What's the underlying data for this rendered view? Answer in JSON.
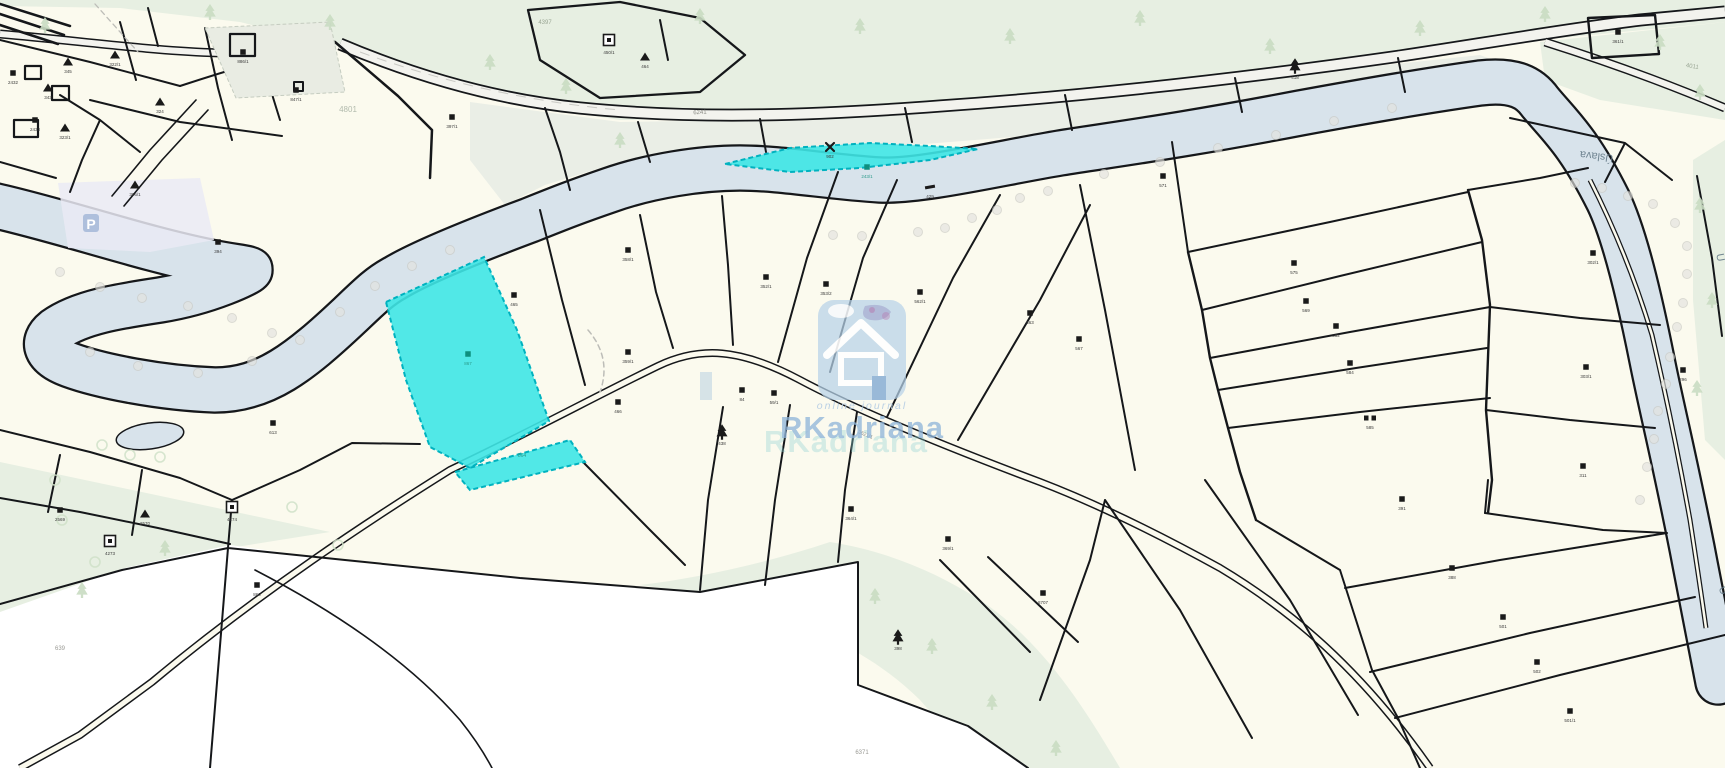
{
  "map": {
    "title": "cadastral-parcel-map",
    "watermark": {
      "brand": "RKadriana",
      "brand_echo": "RKadriana",
      "tagline": "online journal"
    },
    "parking_symbol": "P",
    "colors": {
      "paper": "#fbfaee",
      "forest": "#e7efe2",
      "roadband": "#eaeee6",
      "river": "#d8e3eb",
      "line": "#15171a",
      "white_area": "#ffffff",
      "highlight": "#3ee6e6",
      "highlight_edge": "#00b2bf",
      "watermark_blue": "#8fb5da",
      "watermark_teal": "#8fd2d2",
      "parking": "#aebfdc",
      "dot": "#e3e3df",
      "bush": "#cfe0c8",
      "tree_soft": "#c9dcc2"
    },
    "labels": [
      {
        "t": "Úslava",
        "x": 1597,
        "y": 153,
        "r": 187,
        "s": 11,
        "c": "#647a88",
        "o": 0.9
      },
      {
        "t": "Ú",
        "x": 1717,
        "y": 258,
        "r": 80,
        "s": 11,
        "c": "#647a88",
        "o": 0.9
      },
      {
        "t": "Ú",
        "x": 1720,
        "y": 592,
        "r": 65,
        "s": 11,
        "c": "#647a88",
        "o": 0.9
      },
      {
        "t": "6241",
        "x": 700,
        "y": 114,
        "r": -3,
        "s": 6,
        "c": "#8a8a84",
        "o": 1
      },
      {
        "t": "3621/1",
        "x": 865,
        "y": 436,
        "r": 22,
        "s": 5,
        "c": "#8a8a84",
        "o": 1
      },
      {
        "t": "4397",
        "x": 545,
        "y": 24,
        "r": 0,
        "s": 6,
        "c": "#9aa694",
        "o": 1
      },
      {
        "t": "4801",
        "x": 348,
        "y": 112,
        "r": 0,
        "s": 8,
        "c": "#aab4a6",
        "o": 0.9
      },
      {
        "t": "6371",
        "x": 862,
        "y": 754,
        "r": 0,
        "s": 6,
        "c": "#9a9a94",
        "o": 1
      },
      {
        "t": "4011",
        "x": 1692,
        "y": 68,
        "r": 10,
        "s": 6,
        "c": "#9aa694",
        "o": 1
      },
      {
        "t": "864",
        "x": 522,
        "y": 457,
        "r": 0,
        "s": 5,
        "c": "#2a9a8a",
        "o": 1
      },
      {
        "t": "639",
        "x": 60,
        "y": 650,
        "r": 0,
        "s": 6,
        "c": "#9a9a94",
        "o": 1
      }
    ],
    "markers": [
      {
        "x": 13,
        "y": 73,
        "sym": "sq",
        "label": "2432"
      },
      {
        "x": 48,
        "y": 88,
        "sym": "tri",
        "label": "343"
      },
      {
        "x": 68,
        "y": 62,
        "sym": "tri",
        "label": "345"
      },
      {
        "x": 115,
        "y": 55,
        "sym": "tri",
        "label": "322/1"
      },
      {
        "x": 35,
        "y": 120,
        "sym": "sq",
        "label": "2433"
      },
      {
        "x": 65,
        "y": 128,
        "sym": "tri",
        "label": "323/1"
      },
      {
        "x": 160,
        "y": 102,
        "sym": "tri",
        "label": "324"
      },
      {
        "x": 135,
        "y": 185,
        "sym": "tri",
        "label": "396/1"
      },
      {
        "x": 243,
        "y": 52,
        "sym": "sq",
        "label": "886/1"
      },
      {
        "x": 296,
        "y": 90,
        "sym": "sq",
        "label": "847/1"
      },
      {
        "x": 452,
        "y": 117,
        "sym": "sq",
        "label": "397/1"
      },
      {
        "x": 609,
        "y": 40,
        "sym": "sq2",
        "label": "450/1"
      },
      {
        "x": 645,
        "y": 57,
        "sym": "tri",
        "label": "464"
      },
      {
        "x": 830,
        "y": 147,
        "sym": "x",
        "label": "902"
      },
      {
        "x": 867,
        "y": 167,
        "sym": "sq",
        "label": "243/1",
        "teal": true
      },
      {
        "x": 930,
        "y": 187,
        "sym": "dash",
        "label": "429"
      },
      {
        "x": 1295,
        "y": 66,
        "sym": "tree",
        "label": "418"
      },
      {
        "x": 1618,
        "y": 32,
        "sym": "sq",
        "label": "361/1"
      },
      {
        "x": 218,
        "y": 242,
        "sym": "sq",
        "label": "394"
      },
      {
        "x": 468,
        "y": 354,
        "sym": "sq",
        "label": "867",
        "teal": true
      },
      {
        "x": 514,
        "y": 295,
        "sym": "sq",
        "label": "465"
      },
      {
        "x": 628,
        "y": 250,
        "sym": "sq",
        "label": "358/1"
      },
      {
        "x": 628,
        "y": 352,
        "sym": "sq",
        "label": "359/1"
      },
      {
        "x": 618,
        "y": 402,
        "sym": "sq",
        "label": "466"
      },
      {
        "x": 722,
        "y": 432,
        "sym": "tree",
        "label": "438"
      },
      {
        "x": 766,
        "y": 277,
        "sym": "sq",
        "label": "352/1"
      },
      {
        "x": 826,
        "y": 284,
        "sym": "sq",
        "label": "353/2"
      },
      {
        "x": 920,
        "y": 292,
        "sym": "sq",
        "label": "562/1"
      },
      {
        "x": 1030,
        "y": 313,
        "sym": "sq",
        "label": "563"
      },
      {
        "x": 1079,
        "y": 339,
        "sym": "sq",
        "label": "567"
      },
      {
        "x": 742,
        "y": 390,
        "sym": "sq",
        "label": "84"
      },
      {
        "x": 774,
        "y": 393,
        "sym": "sq",
        "label": "59/1"
      },
      {
        "x": 851,
        "y": 509,
        "sym": "sq",
        "label": "364/1"
      },
      {
        "x": 948,
        "y": 539,
        "sym": "sq",
        "label": "369/1"
      },
      {
        "x": 1043,
        "y": 593,
        "sym": "sq",
        "label": "8707"
      },
      {
        "x": 898,
        "y": 637,
        "sym": "tree",
        "label": "398"
      },
      {
        "x": 1163,
        "y": 176,
        "sym": "sq",
        "label": "571"
      },
      {
        "x": 1294,
        "y": 263,
        "sym": "sq",
        "label": "575"
      },
      {
        "x": 1306,
        "y": 301,
        "sym": "sq",
        "label": "569"
      },
      {
        "x": 1336,
        "y": 326,
        "sym": "sq",
        "label": "582"
      },
      {
        "x": 1350,
        "y": 363,
        "sym": "sq",
        "label": "584"
      },
      {
        "x": 1370,
        "y": 418,
        "sym": "dsq",
        "label": "585"
      },
      {
        "x": 1593,
        "y": 253,
        "sym": "sq",
        "label": "302/1"
      },
      {
        "x": 1586,
        "y": 367,
        "sym": "sq",
        "label": "303/1"
      },
      {
        "x": 1583,
        "y": 466,
        "sym": "sq",
        "label": "311"
      },
      {
        "x": 1683,
        "y": 370,
        "sym": "sq",
        "label": "296"
      },
      {
        "x": 1402,
        "y": 499,
        "sym": "sq",
        "label": "391"
      },
      {
        "x": 1452,
        "y": 568,
        "sym": "sq",
        "label": "388"
      },
      {
        "x": 1503,
        "y": 617,
        "sym": "sq",
        "label": "501"
      },
      {
        "x": 1537,
        "y": 662,
        "sym": "sq",
        "label": "502"
      },
      {
        "x": 1570,
        "y": 711,
        "sym": "sq",
        "label": "501/1"
      },
      {
        "x": 273,
        "y": 423,
        "sym": "sq",
        "label": "613"
      },
      {
        "x": 145,
        "y": 514,
        "sym": "tri",
        "label": "2570"
      },
      {
        "x": 232,
        "y": 507,
        "sym": "sq2",
        "label": "4274"
      },
      {
        "x": 110,
        "y": 541,
        "sym": "sq2",
        "label": "4273"
      },
      {
        "x": 60,
        "y": 510,
        "sym": "sq",
        "label": "2569"
      },
      {
        "x": 257,
        "y": 585,
        "sym": "sq",
        "label": "860"
      }
    ],
    "dots": [
      [
        60,
        272
      ],
      [
        100,
        287
      ],
      [
        142,
        298
      ],
      [
        188,
        306
      ],
      [
        232,
        318
      ],
      [
        272,
        333
      ],
      [
        90,
        352
      ],
      [
        138,
        366
      ],
      [
        198,
        373
      ],
      [
        252,
        361
      ],
      [
        300,
        340
      ],
      [
        340,
        312
      ],
      [
        375,
        286
      ],
      [
        412,
        266
      ],
      [
        450,
        250
      ],
      [
        833,
        235
      ],
      [
        862,
        236
      ],
      [
        918,
        232
      ],
      [
        945,
        228
      ],
      [
        972,
        218
      ],
      [
        997,
        210
      ],
      [
        1020,
        198
      ],
      [
        1048,
        191
      ],
      [
        1104,
        174
      ],
      [
        1160,
        162
      ],
      [
        1218,
        148
      ],
      [
        1276,
        135
      ],
      [
        1334,
        121
      ],
      [
        1392,
        108
      ],
      [
        1575,
        183
      ],
      [
        1602,
        188
      ],
      [
        1628,
        196
      ],
      [
        1653,
        204
      ],
      [
        1675,
        223
      ],
      [
        1687,
        246
      ],
      [
        1687,
        274
      ],
      [
        1683,
        303
      ],
      [
        1677,
        327
      ],
      [
        1670,
        357
      ],
      [
        1666,
        384
      ],
      [
        1658,
        411
      ],
      [
        1654,
        439
      ],
      [
        1647,
        467
      ],
      [
        1640,
        500
      ]
    ],
    "trees": [
      [
        45,
        25
      ],
      [
        210,
        12
      ],
      [
        330,
        22
      ],
      [
        490,
        62
      ],
      [
        566,
        86
      ],
      [
        700,
        16
      ],
      [
        860,
        26
      ],
      [
        1010,
        36
      ],
      [
        1140,
        18
      ],
      [
        1270,
        46
      ],
      [
        1420,
        28
      ],
      [
        1545,
        14
      ],
      [
        1660,
        42
      ],
      [
        1700,
        92
      ],
      [
        620,
        140
      ],
      [
        1700,
        205
      ],
      [
        1712,
        300
      ],
      [
        1697,
        388
      ],
      [
        165,
        548
      ],
      [
        82,
        590
      ],
      [
        875,
        596
      ],
      [
        932,
        646
      ],
      [
        992,
        702
      ],
      [
        1056,
        748
      ]
    ],
    "bushes": [
      [
        102,
        445
      ],
      [
        130,
        455
      ],
      [
        160,
        457
      ],
      [
        62,
        520
      ],
      [
        95,
        562
      ],
      [
        338,
        545
      ],
      [
        292,
        507
      ],
      [
        55,
        480
      ]
    ]
  }
}
